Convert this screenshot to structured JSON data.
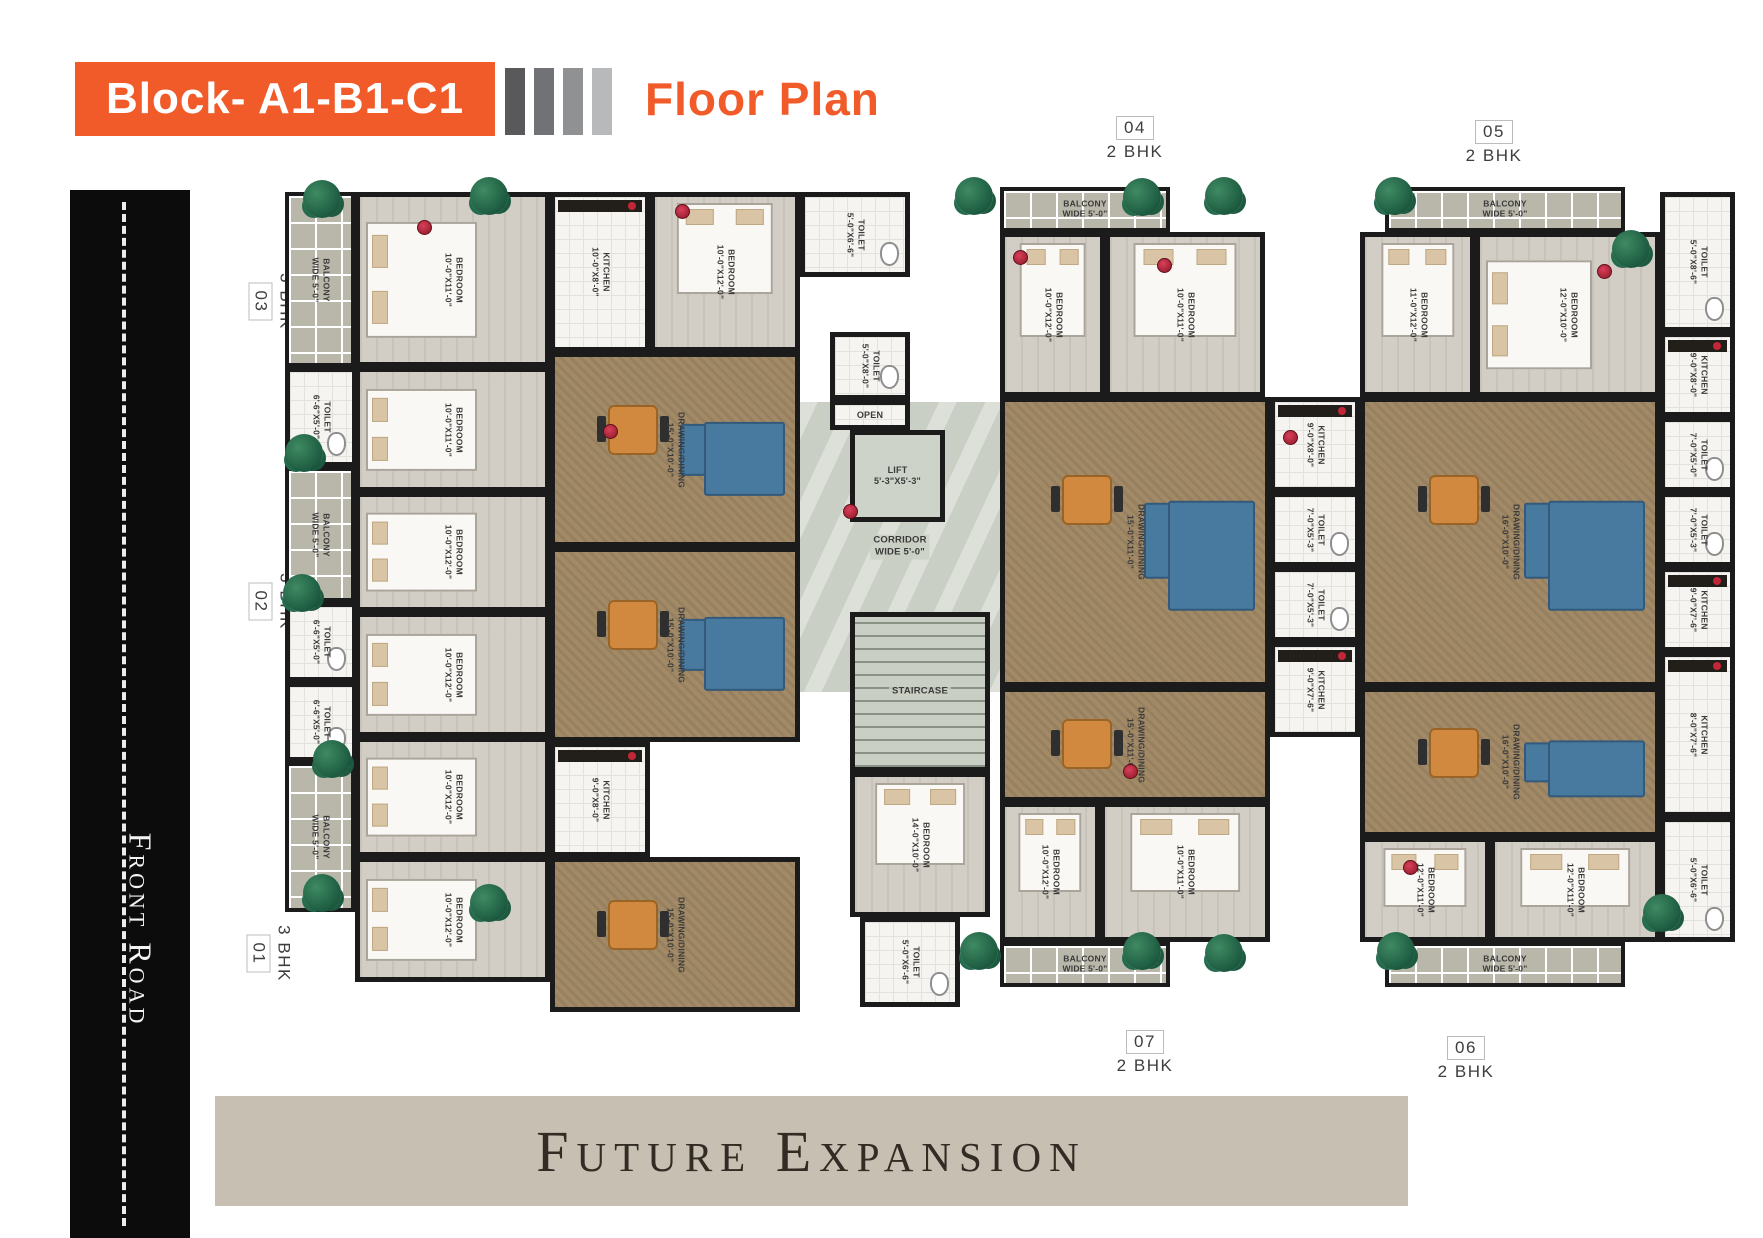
{
  "header": {
    "block_label": "Block- A1-B1-C1",
    "page_title": "Floor Plan",
    "accent_color": "#f15a29",
    "divider_bar_colors": [
      "#59595c",
      "#717275",
      "#8f9193",
      "#b7b9bb"
    ]
  },
  "left_road": {
    "label": "Front Road"
  },
  "footer": {
    "label": "Future Expansion",
    "bg_color": "#c6bfb2"
  },
  "units": [
    {
      "number": "04",
      "type": "2 BHK"
    },
    {
      "number": "05",
      "type": "2 BHK"
    },
    {
      "number": "03",
      "type": "3 BHK"
    },
    {
      "number": "02",
      "type": "3 BHK"
    },
    {
      "number": "01",
      "type": "3 BHK"
    },
    {
      "number": "07",
      "type": "2 BHK"
    },
    {
      "number": "06",
      "type": "2 BHK"
    }
  ],
  "plan": {
    "rooms": [
      {
        "kind": "balcony",
        "label": "BALCONY",
        "dim": "WIDE 5'-0\"",
        "x": 30,
        "y": 20,
        "w": 70,
        "h": 175,
        "rot": true
      },
      {
        "kind": "bedroom",
        "label": "BEDROOM",
        "dim": "10'-0\"X11'-0\"",
        "x": 100,
        "y": 20,
        "w": 195,
        "h": 175,
        "rot": true,
        "furn": [
          "bed-h"
        ]
      },
      {
        "kind": "toilet",
        "label": "TOILET",
        "dim": "6'-6\"X5'-0\"",
        "x": 30,
        "y": 195,
        "w": 72,
        "h": 100,
        "rot": true,
        "furn": [
          "wc"
        ]
      },
      {
        "kind": "bedroom",
        "label": "BEDROOM",
        "dim": "10'-0\"X11'-0\"",
        "x": 100,
        "y": 195,
        "w": 195,
        "h": 125,
        "rot": true,
        "furn": [
          "bed-h"
        ]
      },
      {
        "kind": "balcony",
        "label": "BALCONY",
        "dim": "WIDE 5'-0\"",
        "x": 30,
        "y": 295,
        "w": 70,
        "h": 135,
        "rot": true
      },
      {
        "kind": "bedroom",
        "label": "BEDROOM",
        "dim": "10'-0\"X12'-0\"",
        "x": 100,
        "y": 320,
        "w": 195,
        "h": 120,
        "rot": true,
        "furn": [
          "bed-h"
        ]
      },
      {
        "kind": "toilet",
        "label": "TOILET",
        "dim": "6'-6\"X5'-0\"",
        "x": 30,
        "y": 430,
        "w": 72,
        "h": 80,
        "rot": true,
        "furn": [
          "wc"
        ]
      },
      {
        "kind": "toilet",
        "label": "TOILET",
        "dim": "6'-6\"X5'-0\"",
        "x": 30,
        "y": 510,
        "w": 72,
        "h": 80,
        "rot": true,
        "furn": [
          "wc"
        ]
      },
      {
        "kind": "bedroom",
        "label": "BEDROOM",
        "dim": "10'-0\"X12'-0\"",
        "x": 100,
        "y": 440,
        "w": 195,
        "h": 125,
        "rot": true,
        "furn": [
          "bed-h"
        ]
      },
      {
        "kind": "balcony",
        "label": "BALCONY",
        "dim": "WIDE 5'-0\"",
        "x": 30,
        "y": 590,
        "w": 70,
        "h": 150,
        "rot": true
      },
      {
        "kind": "bedroom",
        "label": "BEDROOM",
        "dim": "10'-0\"X12'-0\"",
        "x": 100,
        "y": 565,
        "w": 195,
        "h": 120,
        "rot": true,
        "furn": [
          "bed-h"
        ]
      },
      {
        "kind": "bedroom",
        "label": "BEDROOM",
        "dim": "10'-0\"X12'-0\"",
        "x": 100,
        "y": 685,
        "w": 195,
        "h": 125,
        "rot": true,
        "furn": [
          "bed-h"
        ]
      },
      {
        "kind": "kitchen",
        "label": "KITCHEN",
        "dim": "10'-0\"X8'-0\"",
        "x": 295,
        "y": 20,
        "w": 100,
        "h": 160,
        "rot": true,
        "furn": [
          "counter"
        ]
      },
      {
        "kind": "bedroom",
        "label": "BEDROOM",
        "dim": "10'-0\"X12'-0\"",
        "x": 395,
        "y": 20,
        "w": 150,
        "h": 160,
        "rot": true,
        "furn": [
          "bed-v"
        ]
      },
      {
        "kind": "living",
        "label": "DRAWING/DINING",
        "dim": "15'-0\"X10'-0\"",
        "x": 295,
        "y": 180,
        "w": 250,
        "h": 195,
        "rot": true,
        "furn": [
          "table",
          "sofa"
        ]
      },
      {
        "kind": "living",
        "label": "DRAWING/DINING",
        "dim": "15'-0\"X10'-0\"",
        "x": 295,
        "y": 375,
        "w": 250,
        "h": 195,
        "rot": true,
        "furn": [
          "table",
          "sofa"
        ]
      },
      {
        "kind": "kitchen",
        "label": "KITCHEN",
        "dim": "9'-0\"X8'-0\"",
        "x": 295,
        "y": 570,
        "w": 100,
        "h": 115,
        "rot": true,
        "furn": [
          "counter"
        ]
      },
      {
        "kind": "living",
        "label": "DRAWING/DINING",
        "dim": "15'-0\"X10'-0\"",
        "x": 295,
        "y": 685,
        "w": 250,
        "h": 155,
        "rot": true,
        "furn": [
          "table"
        ]
      },
      {
        "kind": "toilet",
        "label": "TOILET",
        "dim": "5'-0\"X6'-6\"",
        "x": 545,
        "y": 20,
        "w": 110,
        "h": 85,
        "rot": true,
        "furn": [
          "wc"
        ]
      },
      {
        "kind": "corridor",
        "label": "CORRIDOR",
        "dim": "WIDE 5'-0\"",
        "x": 545,
        "y": 230,
        "w": 200,
        "h": 290,
        "rot": false
      },
      {
        "kind": "toilet",
        "label": "TOILET",
        "dim": "5'-0\"X8'-0\"",
        "x": 575,
        "y": 160,
        "w": 80,
        "h": 68,
        "rot": true,
        "furn": [
          "wc"
        ]
      },
      {
        "kind": "open",
        "label": "OPEN",
        "x": 575,
        "y": 228,
        "w": 80,
        "h": 30,
        "rot": false
      },
      {
        "kind": "lift",
        "label": "LIFT",
        "dim": "5'-3\"X5'-3\"",
        "x": 595,
        "y": 258,
        "w": 95,
        "h": 92,
        "rot": false
      },
      {
        "kind": "stair",
        "label": "STAIRCASE",
        "x": 595,
        "y": 440,
        "w": 140,
        "h": 160,
        "rot": false
      },
      {
        "kind": "bedroom",
        "label": "BEDROOM",
        "dim": "14'-0\"X10'-0\"",
        "x": 595,
        "y": 600,
        "w": 140,
        "h": 145,
        "rot": true,
        "furn": [
          "bed-v"
        ]
      },
      {
        "kind": "toilet",
        "label": "TOILET",
        "dim": "5'-0\"X6'-6\"",
        "x": 605,
        "y": 745,
        "w": 100,
        "h": 90,
        "rot": true,
        "furn": [
          "wc"
        ]
      },
      {
        "kind": "balcony",
        "label": "BALCONY",
        "dim": "WIDE 5'-0\"",
        "x": 745,
        "y": 15,
        "w": 170,
        "h": 45,
        "rot": false
      },
      {
        "kind": "bedroom",
        "label": "BEDROOM",
        "dim": "10'-0\"X12'-0\"",
        "x": 745,
        "y": 60,
        "w": 105,
        "h": 165,
        "rot": true,
        "furn": [
          "bed-v"
        ]
      },
      {
        "kind": "bedroom",
        "label": "BEDROOM",
        "dim": "10'-0\"X11'-0\"",
        "x": 850,
        "y": 60,
        "w": 160,
        "h": 165,
        "rot": true,
        "furn": [
          "bed-v"
        ]
      },
      {
        "kind": "living",
        "label": "DRAWING/DINING",
        "dim": "15'-0\"X11'-0\"",
        "x": 745,
        "y": 225,
        "w": 270,
        "h": 290,
        "rot": true,
        "furn": [
          "sofa",
          "table"
        ]
      },
      {
        "kind": "kitchen",
        "label": "KITCHEN",
        "dim": "9'-0\"X8'-0\"",
        "x": 1015,
        "y": 225,
        "w": 90,
        "h": 95,
        "rot": true,
        "furn": [
          "counter"
        ]
      },
      {
        "kind": "toilet",
        "label": "TOILET",
        "dim": "7'-0\"X5'-3\"",
        "x": 1015,
        "y": 320,
        "w": 90,
        "h": 75,
        "rot": true,
        "furn": [
          "wc"
        ]
      },
      {
        "kind": "toilet",
        "label": "TOILET",
        "dim": "7'-0\"X5'-3\"",
        "x": 1015,
        "y": 395,
        "w": 90,
        "h": 75,
        "rot": true,
        "furn": [
          "wc"
        ]
      },
      {
        "kind": "kitchen",
        "label": "KITCHEN",
        "dim": "9'-0\"X7'-6\"",
        "x": 1015,
        "y": 470,
        "w": 90,
        "h": 95,
        "rot": true,
        "furn": [
          "counter"
        ]
      },
      {
        "kind": "living",
        "label": "DRAWING/DINING",
        "dim": "15'-0\"X11'-0\"",
        "x": 745,
        "y": 515,
        "w": 270,
        "h": 115,
        "rot": true,
        "furn": [
          "table"
        ]
      },
      {
        "kind": "bedroom",
        "label": "BEDROOM",
        "dim": "10'-0\"X12'-0\"",
        "x": 745,
        "y": 630,
        "w": 100,
        "h": 140,
        "rot": true,
        "furn": [
          "bed-v"
        ]
      },
      {
        "kind": "bedroom",
        "label": "BEDROOM",
        "dim": "10'-0\"X11'-0\"",
        "x": 845,
        "y": 630,
        "w": 170,
        "h": 140,
        "rot": true,
        "furn": [
          "bed-v"
        ]
      },
      {
        "kind": "balcony",
        "label": "BALCONY",
        "dim": "WIDE 5'-0\"",
        "x": 745,
        "y": 770,
        "w": 170,
        "h": 45,
        "rot": false
      },
      {
        "kind": "balcony",
        "label": "BALCONY",
        "dim": "WIDE 5'-0\"",
        "x": 1130,
        "y": 15,
        "w": 240,
        "h": 45,
        "rot": false
      },
      {
        "kind": "toilet",
        "label": "TOILET",
        "dim": "5'-0\"X8'-6\"",
        "x": 1405,
        "y": 20,
        "w": 75,
        "h": 140,
        "rot": true,
        "furn": [
          "wc"
        ]
      },
      {
        "kind": "bedroom",
        "label": "BEDROOM",
        "dim": "11'-0\"X12'-0\"",
        "x": 1105,
        "y": 60,
        "w": 115,
        "h": 165,
        "rot": true,
        "furn": [
          "bed-v"
        ]
      },
      {
        "kind": "bedroom",
        "label": "BEDROOM",
        "dim": "12'-0\"X10'-0\"",
        "x": 1220,
        "y": 60,
        "w": 185,
        "h": 165,
        "rot": true,
        "furn": [
          "bed-h"
        ]
      },
      {
        "kind": "kitchen",
        "label": "KITCHEN",
        "dim": "9'-0\"X8'-0\"",
        "x": 1405,
        "y": 160,
        "w": 75,
        "h": 85,
        "rot": true,
        "furn": [
          "counter"
        ]
      },
      {
        "kind": "living",
        "label": "DRAWING/DINING",
        "dim": "16'-0\"X10'-0\"",
        "x": 1105,
        "y": 225,
        "w": 300,
        "h": 290,
        "rot": true,
        "furn": [
          "table",
          "sofa"
        ]
      },
      {
        "kind": "toilet",
        "label": "TOILET",
        "dim": "7'-0\"X5'-0\"",
        "x": 1405,
        "y": 245,
        "w": 75,
        "h": 75,
        "rot": true,
        "furn": [
          "wc"
        ]
      },
      {
        "kind": "toilet",
        "label": "TOILET",
        "dim": "7'-0\"X5'-3\"",
        "x": 1405,
        "y": 320,
        "w": 75,
        "h": 75,
        "rot": true,
        "furn": [
          "wc"
        ]
      },
      {
        "kind": "kitchen",
        "label": "KITCHEN",
        "dim": "9'-0\"X7'-6\"",
        "x": 1405,
        "y": 395,
        "w": 75,
        "h": 85,
        "rot": true,
        "furn": [
          "counter"
        ]
      },
      {
        "kind": "kitchen",
        "label": "KITCHEN",
        "dim": "8'-0\"X7'-6\"",
        "x": 1405,
        "y": 480,
        "w": 75,
        "h": 165,
        "rot": true,
        "furn": [
          "counter"
        ]
      },
      {
        "kind": "living",
        "label": "DRAWING/DINING",
        "dim": "16'-0\"X10'-0\"",
        "x": 1105,
        "y": 515,
        "w": 300,
        "h": 150,
        "rot": true,
        "furn": [
          "table",
          "sofa"
        ]
      },
      {
        "kind": "bedroom",
        "label": "BEDROOM",
        "dim": "12'-0\"X11'-0\"",
        "x": 1105,
        "y": 665,
        "w": 130,
        "h": 105,
        "rot": true,
        "furn": [
          "bed-v"
        ]
      },
      {
        "kind": "bedroom",
        "label": "BEDROOM",
        "dim": "12'-0\"X11'-0\"",
        "x": 1235,
        "y": 665,
        "w": 170,
        "h": 105,
        "rot": true,
        "furn": [
          "bed-v"
        ]
      },
      {
        "kind": "toilet",
        "label": "TOILET",
        "dim": "5'-0\"X6'-6\"",
        "x": 1405,
        "y": 645,
        "w": 75,
        "h": 125,
        "rot": true,
        "furn": [
          "wc"
        ]
      },
      {
        "kind": "balcony",
        "label": "BALCONY",
        "dim": "WIDE 5'-0\"",
        "x": 1130,
        "y": 770,
        "w": 240,
        "h": 45,
        "rot": false
      }
    ],
    "trees": [
      [
        48,
        8
      ],
      [
        215,
        5
      ],
      [
        30,
        262
      ],
      [
        28,
        402
      ],
      [
        58,
        568
      ],
      [
        48,
        702
      ],
      [
        215,
        712
      ],
      [
        700,
        5
      ],
      [
        868,
        6
      ],
      [
        950,
        5
      ],
      [
        1120,
        5
      ],
      [
        1357,
        58
      ],
      [
        705,
        760
      ],
      [
        868,
        760
      ],
      [
        950,
        762
      ],
      [
        1122,
        760
      ],
      [
        1388,
        722
      ]
    ],
    "pots": [
      [
        162,
        48
      ],
      [
        420,
        32
      ],
      [
        758,
        78
      ],
      [
        902,
        86
      ],
      [
        1342,
        92
      ],
      [
        588,
        332
      ],
      [
        1028,
        258
      ],
      [
        868,
        592
      ],
      [
        1148,
        688
      ],
      [
        348,
        252
      ]
    ]
  }
}
